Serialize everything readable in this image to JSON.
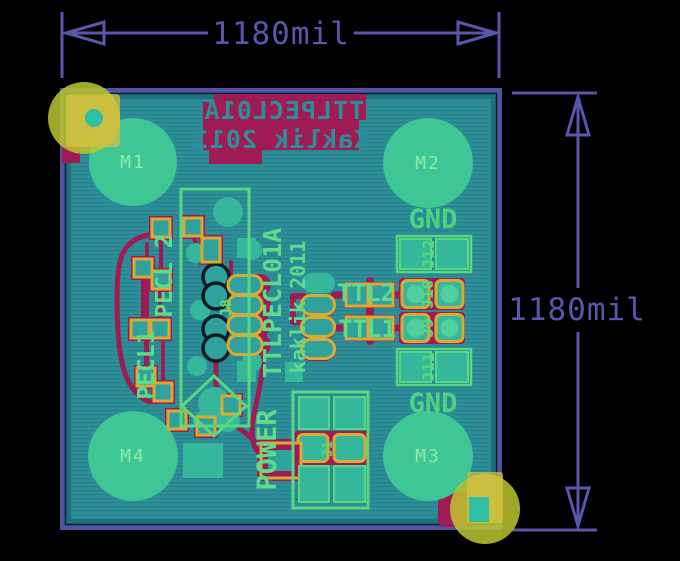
{
  "window": {
    "width": 680,
    "height": 561,
    "background": "#000000"
  },
  "dimensions": {
    "top": {
      "label": "1180mil",
      "orientation": "horizontal"
    },
    "right": {
      "label": "1180mil",
      "orientation": "vertical"
    },
    "color": "#5b56ad"
  },
  "board": {
    "outline_color": "#5551a5",
    "copper_pour_color": "#2d8e99",
    "trace_color": "#9e1b53",
    "pad_ring_color": "#d9ab33",
    "silkscreen": {
      "line1": "TTLPECL01A",
      "line2": "Kaklik 2011",
      "mirrored": true,
      "block_color": "#9e1b53"
    },
    "mount_holes": [
      {
        "label": "M1"
      },
      {
        "label": "M2"
      },
      {
        "label": "M3"
      },
      {
        "label": "M4"
      }
    ],
    "copper_text": {
      "name": "TTLPECL01A",
      "author": "kaklik 2011"
    },
    "labels": {
      "gnd_top": "GND",
      "gnd_bottom": "GND",
      "ttl2": "TTL2",
      "ttl1": "TTL1",
      "power": "POWER",
      "pecl2": "PECL 2",
      "pecl1": "PECL1"
    },
    "ref_des": {
      "j1": "J1",
      "j8": "J8",
      "j9": "J9",
      "j10": "J10",
      "j11": "J11",
      "j12": "J12"
    },
    "corner_marker_color": "#bcc52f"
  }
}
